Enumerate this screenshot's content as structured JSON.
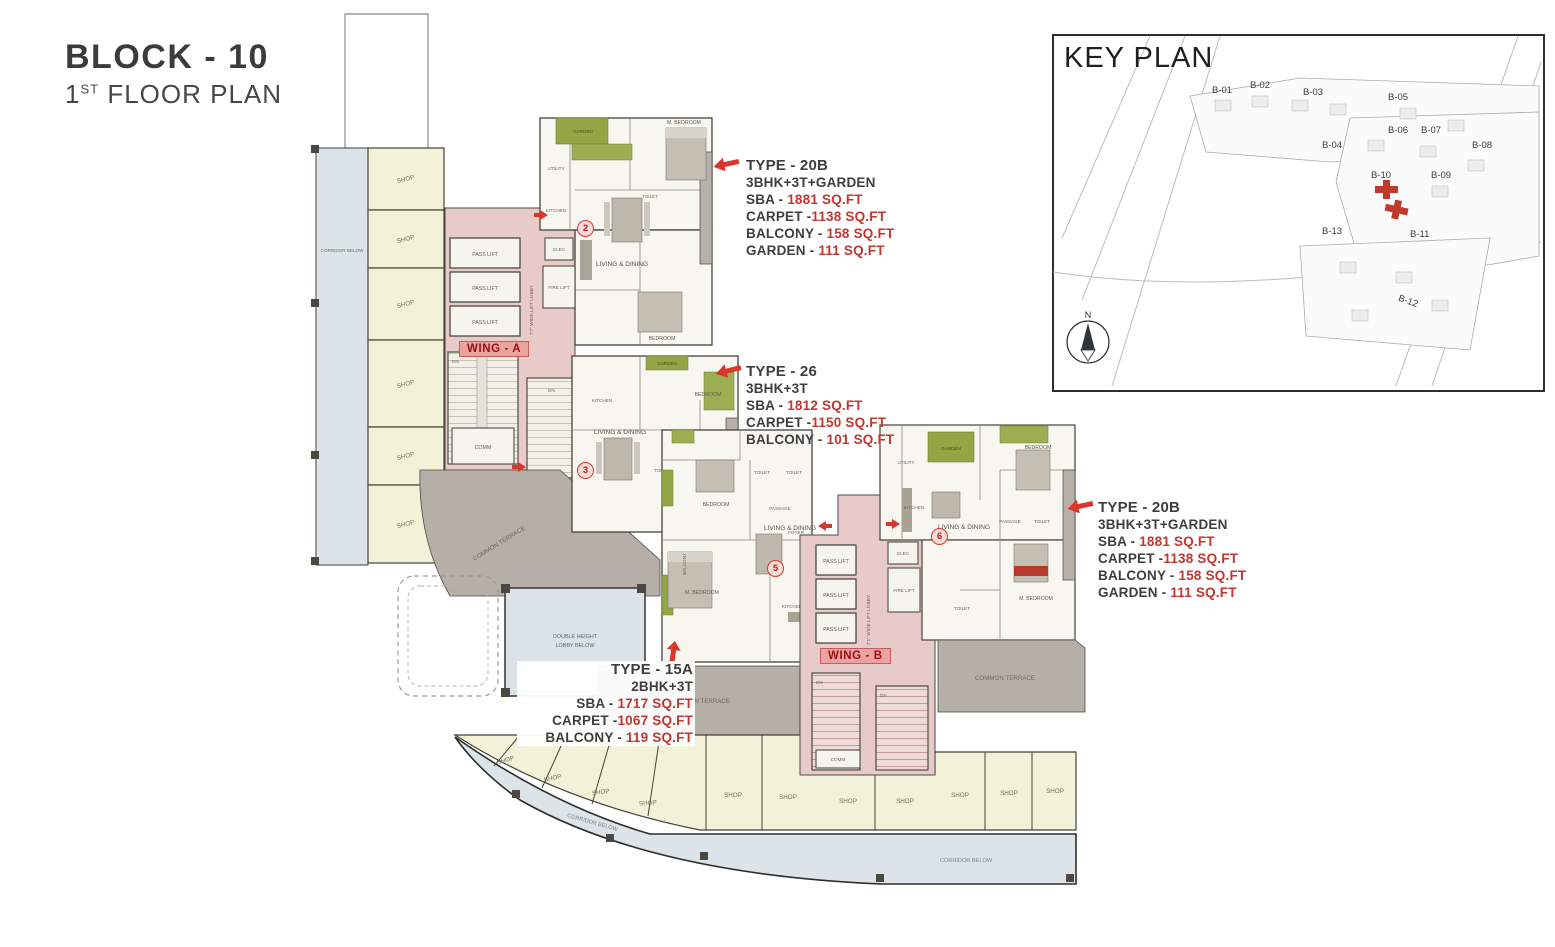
{
  "title": {
    "block": "BLOCK - 10",
    "floor_number": "1",
    "floor_ordinal": "ST",
    "floor_text": " FLOOR PLAN"
  },
  "key_plan": {
    "title": "KEY PLAN",
    "compass": "N",
    "highlighted_block": "B-10",
    "blocks": [
      "B-01",
      "B-02",
      "B-03",
      "B-05",
      "B-04",
      "B-06",
      "B-07",
      "B-08",
      "B-10",
      "B-09",
      "B-13",
      "B-11",
      "B-12"
    ]
  },
  "annotations": {
    "type20b_top": {
      "title": "TYPE - 20B",
      "config": "3BHK+3T+GARDEN",
      "rows": [
        {
          "l": "SBA - ",
          "v": "1881 SQ.FT"
        },
        {
          "l": "CARPET -",
          "v": "1138 SQ.FT"
        },
        {
          "l": "BALCONY - ",
          "v": "158 SQ.FT"
        },
        {
          "l": "GARDEN - ",
          "v": "111 SQ.FT"
        }
      ]
    },
    "type26": {
      "title": "TYPE - 26",
      "config": "3BHK+3T",
      "rows": [
        {
          "l": "SBA - ",
          "v": "1812 SQ.FT"
        },
        {
          "l": "CARPET -",
          "v": "1150 SQ.FT"
        },
        {
          "l": "BALCONY - ",
          "v": "101 SQ.FT"
        }
      ]
    },
    "type20b_right": {
      "title": "TYPE - 20B",
      "config": "3BHK+3T+GARDEN",
      "rows": [
        {
          "l": "SBA - ",
          "v": "1881 SQ.FT"
        },
        {
          "l": "CARPET -",
          "v": "1138 SQ.FT"
        },
        {
          "l": "BALCONY - ",
          "v": "158 SQ.FT"
        },
        {
          "l": "GARDEN - ",
          "v": "111 SQ.FT"
        }
      ]
    },
    "type15a": {
      "title": "TYPE - 15A",
      "config": "2BHK+3T",
      "rows": [
        {
          "l": "SBA - ",
          "v": "1717 SQ.FT"
        },
        {
          "l": "CARPET -",
          "v": "1067 SQ.FT"
        },
        {
          "l": "BALCONY - ",
          "v": "119 SQ.FT"
        }
      ]
    }
  },
  "plan": {
    "wing_a": "WING - A",
    "wing_b": "WING - B",
    "unit_markers": [
      "2",
      "3",
      "5",
      "6"
    ],
    "labels": {
      "shop": "SHOP",
      "corridor_below": "CORRIDOR BELOW",
      "common_terrace": "COMMON TERRACE",
      "double_height_1": "DOUBLE HEIGHT",
      "double_height_2": "LOBBY BELOW",
      "pass_lift": "PASS LIFT",
      "fire_lift": "FIRE LIFT",
      "elec": "ELEC",
      "comm": "COMM",
      "up": "UP",
      "dn": "DN",
      "lobby_a": "7'7\" WIDE LIFT LOBBY",
      "lobby_b": "7'1\" WIDE LIFT LOBBY",
      "utility": "UTILITY",
      "kitchen": "KITCHEN",
      "living_dining": "LIVING & DINING",
      "bedroom": "BEDROOM",
      "m_bedroom": "M. BEDROOM",
      "toilet": "TOILET",
      "passage": "PASSAGE",
      "foyer": "FOYER",
      "balcony": "BALCONY",
      "garden": "GARDEN"
    }
  },
  "colors": {
    "accent_red": "#d6382e",
    "wall": "#45433b",
    "core_pink": "#e8cbc8",
    "shop_cream": "#f3f1d8",
    "corridor_blue": "#dce4ea",
    "terrace_gray": "#b6afa7",
    "garden_green": "#92a646"
  }
}
